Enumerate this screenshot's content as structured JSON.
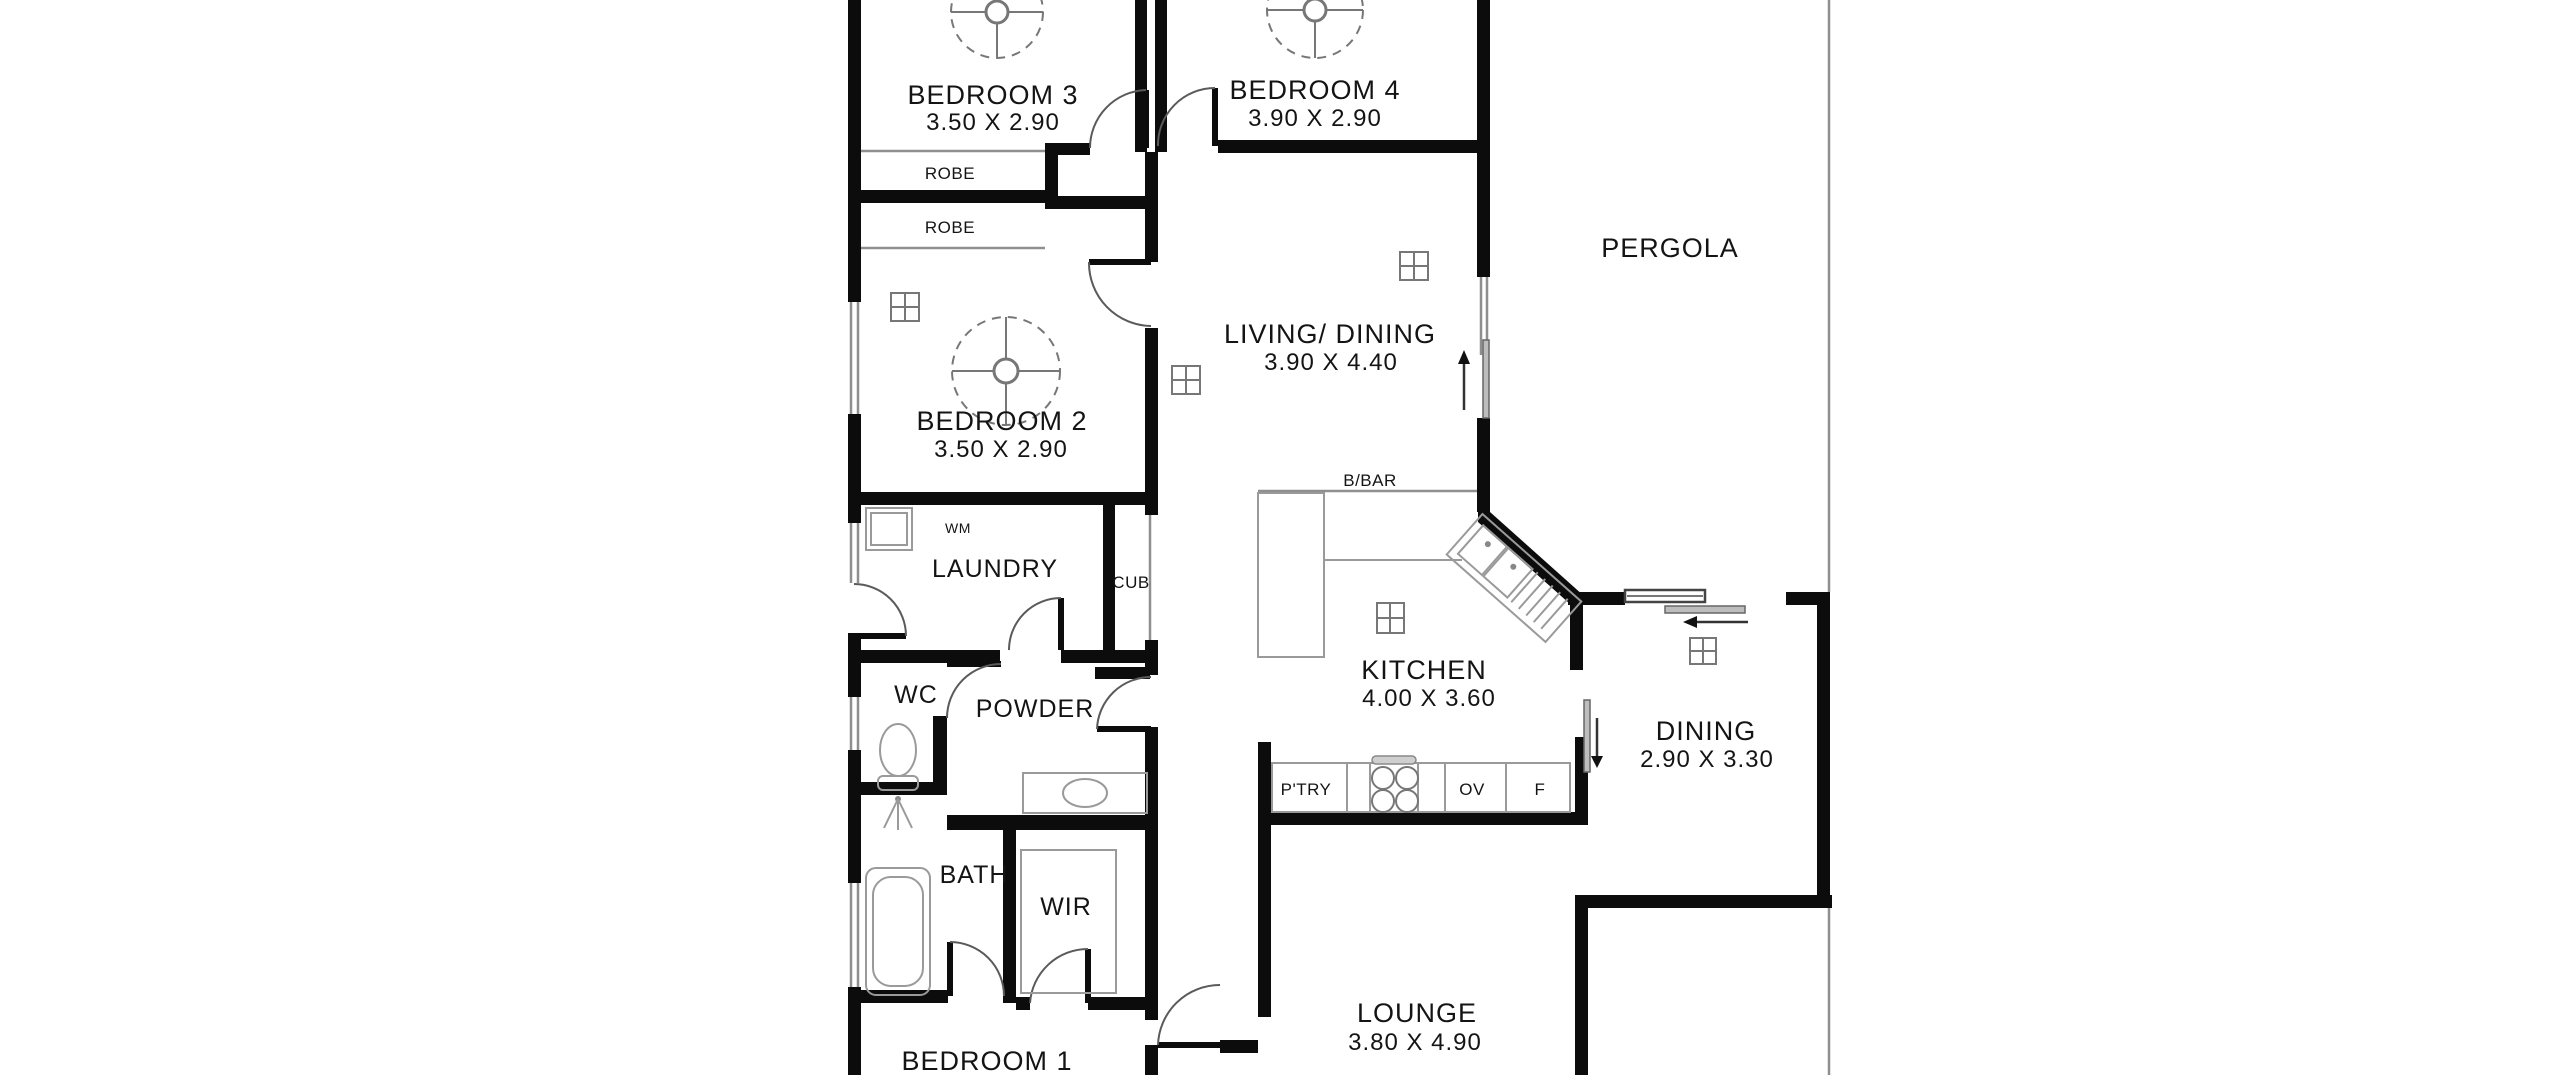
{
  "floor_plan": {
    "rooms": {
      "bedroom3": {
        "label": "BEDROOM 3",
        "dims": "3.50 X 2.90"
      },
      "bedroom4": {
        "label": "BEDROOM 4",
        "dims": "3.90 X 2.90"
      },
      "bedroom2": {
        "label": "BEDROOM 2",
        "dims": "3.50 X 2.90"
      },
      "bedroom1": {
        "label": "BEDROOM 1"
      },
      "living_dining": {
        "label": "LIVING/ DINING",
        "dims": "3.90 X 4.40"
      },
      "kitchen": {
        "label": "KITCHEN",
        "dims": "4.00 X 3.60"
      },
      "dining": {
        "label": "DINING",
        "dims": "2.90 X 3.30"
      },
      "lounge": {
        "label": "LOUNGE",
        "dims": "3.80 X 4.90"
      },
      "pergola": {
        "label": "PERGOLA"
      },
      "laundry": {
        "label": "LAUNDRY"
      },
      "powder": {
        "label": "POWDER"
      },
      "wc": {
        "label": "WC"
      },
      "bath": {
        "label": "BATH"
      },
      "wir": {
        "label": "WIR"
      }
    },
    "fixtures": {
      "robe1": "ROBE",
      "robe2": "ROBE",
      "wm": "WM",
      "cub": "CUB",
      "bbar": "B/BAR",
      "pantry": "P'TRY",
      "oven": "OV",
      "fridge": "F"
    },
    "colors": {
      "wall": "#0c0c0c",
      "thin_line": "#8f8f8f",
      "text": "#141414",
      "background": "#ffffff"
    }
  }
}
